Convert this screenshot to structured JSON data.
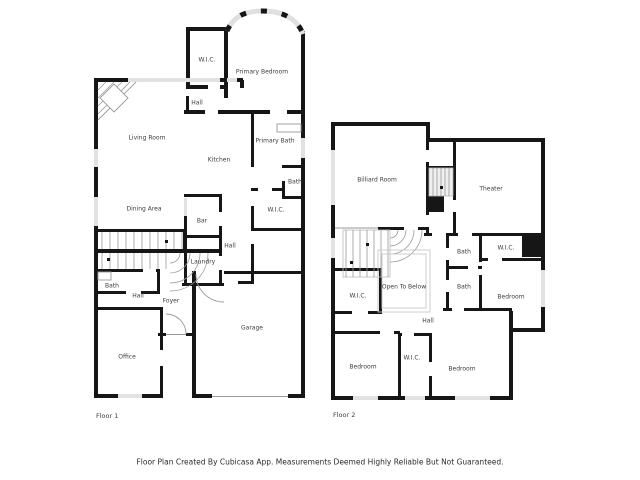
{
  "floor1": {
    "title": "Floor 1",
    "rooms": {
      "wic_primary": "W.I.C.",
      "primary_bedroom": "Primary Bedroom",
      "hall_upper": "Hall",
      "living_room": "Living Room",
      "kitchen": "Kitchen",
      "primary_bath": "Primary Bath",
      "bath_small": "Bath",
      "wic_center": "W.I.C.",
      "dining_area": "Dining Area",
      "bar": "Bar",
      "hall_center": "Hall",
      "laundry": "Laundry",
      "bath_lower": "Bath",
      "hall_lower": "Hall",
      "foyer": "Foyer",
      "office": "Office",
      "garage": "Garage"
    }
  },
  "floor2": {
    "title": "Floor 2",
    "rooms": {
      "billiard_room": "Billiard Room",
      "theater": "Theater",
      "bath_upper": "Bath",
      "bath_lower": "Bath",
      "wic_right": "W.I.C.",
      "bedroom_right": "Bedroom",
      "wic_left": "W.I.C.",
      "open_to_below": "Open To Below",
      "hall": "Hall",
      "bedroom_bottom_left": "Bedroom",
      "wic_bottom": "W.I.C.",
      "bedroom_bottom_right": "Bedroom"
    }
  },
  "footer": {
    "disclaimer": "Floor Plan Created By Cubicasa App. Measurements Deemed Highly Reliable But Not Guaranteed."
  },
  "colors": {
    "wall": "#161616",
    "window": "#e2e2e2",
    "thin_line": "#999999",
    "label_text": "#3c3c3c"
  }
}
